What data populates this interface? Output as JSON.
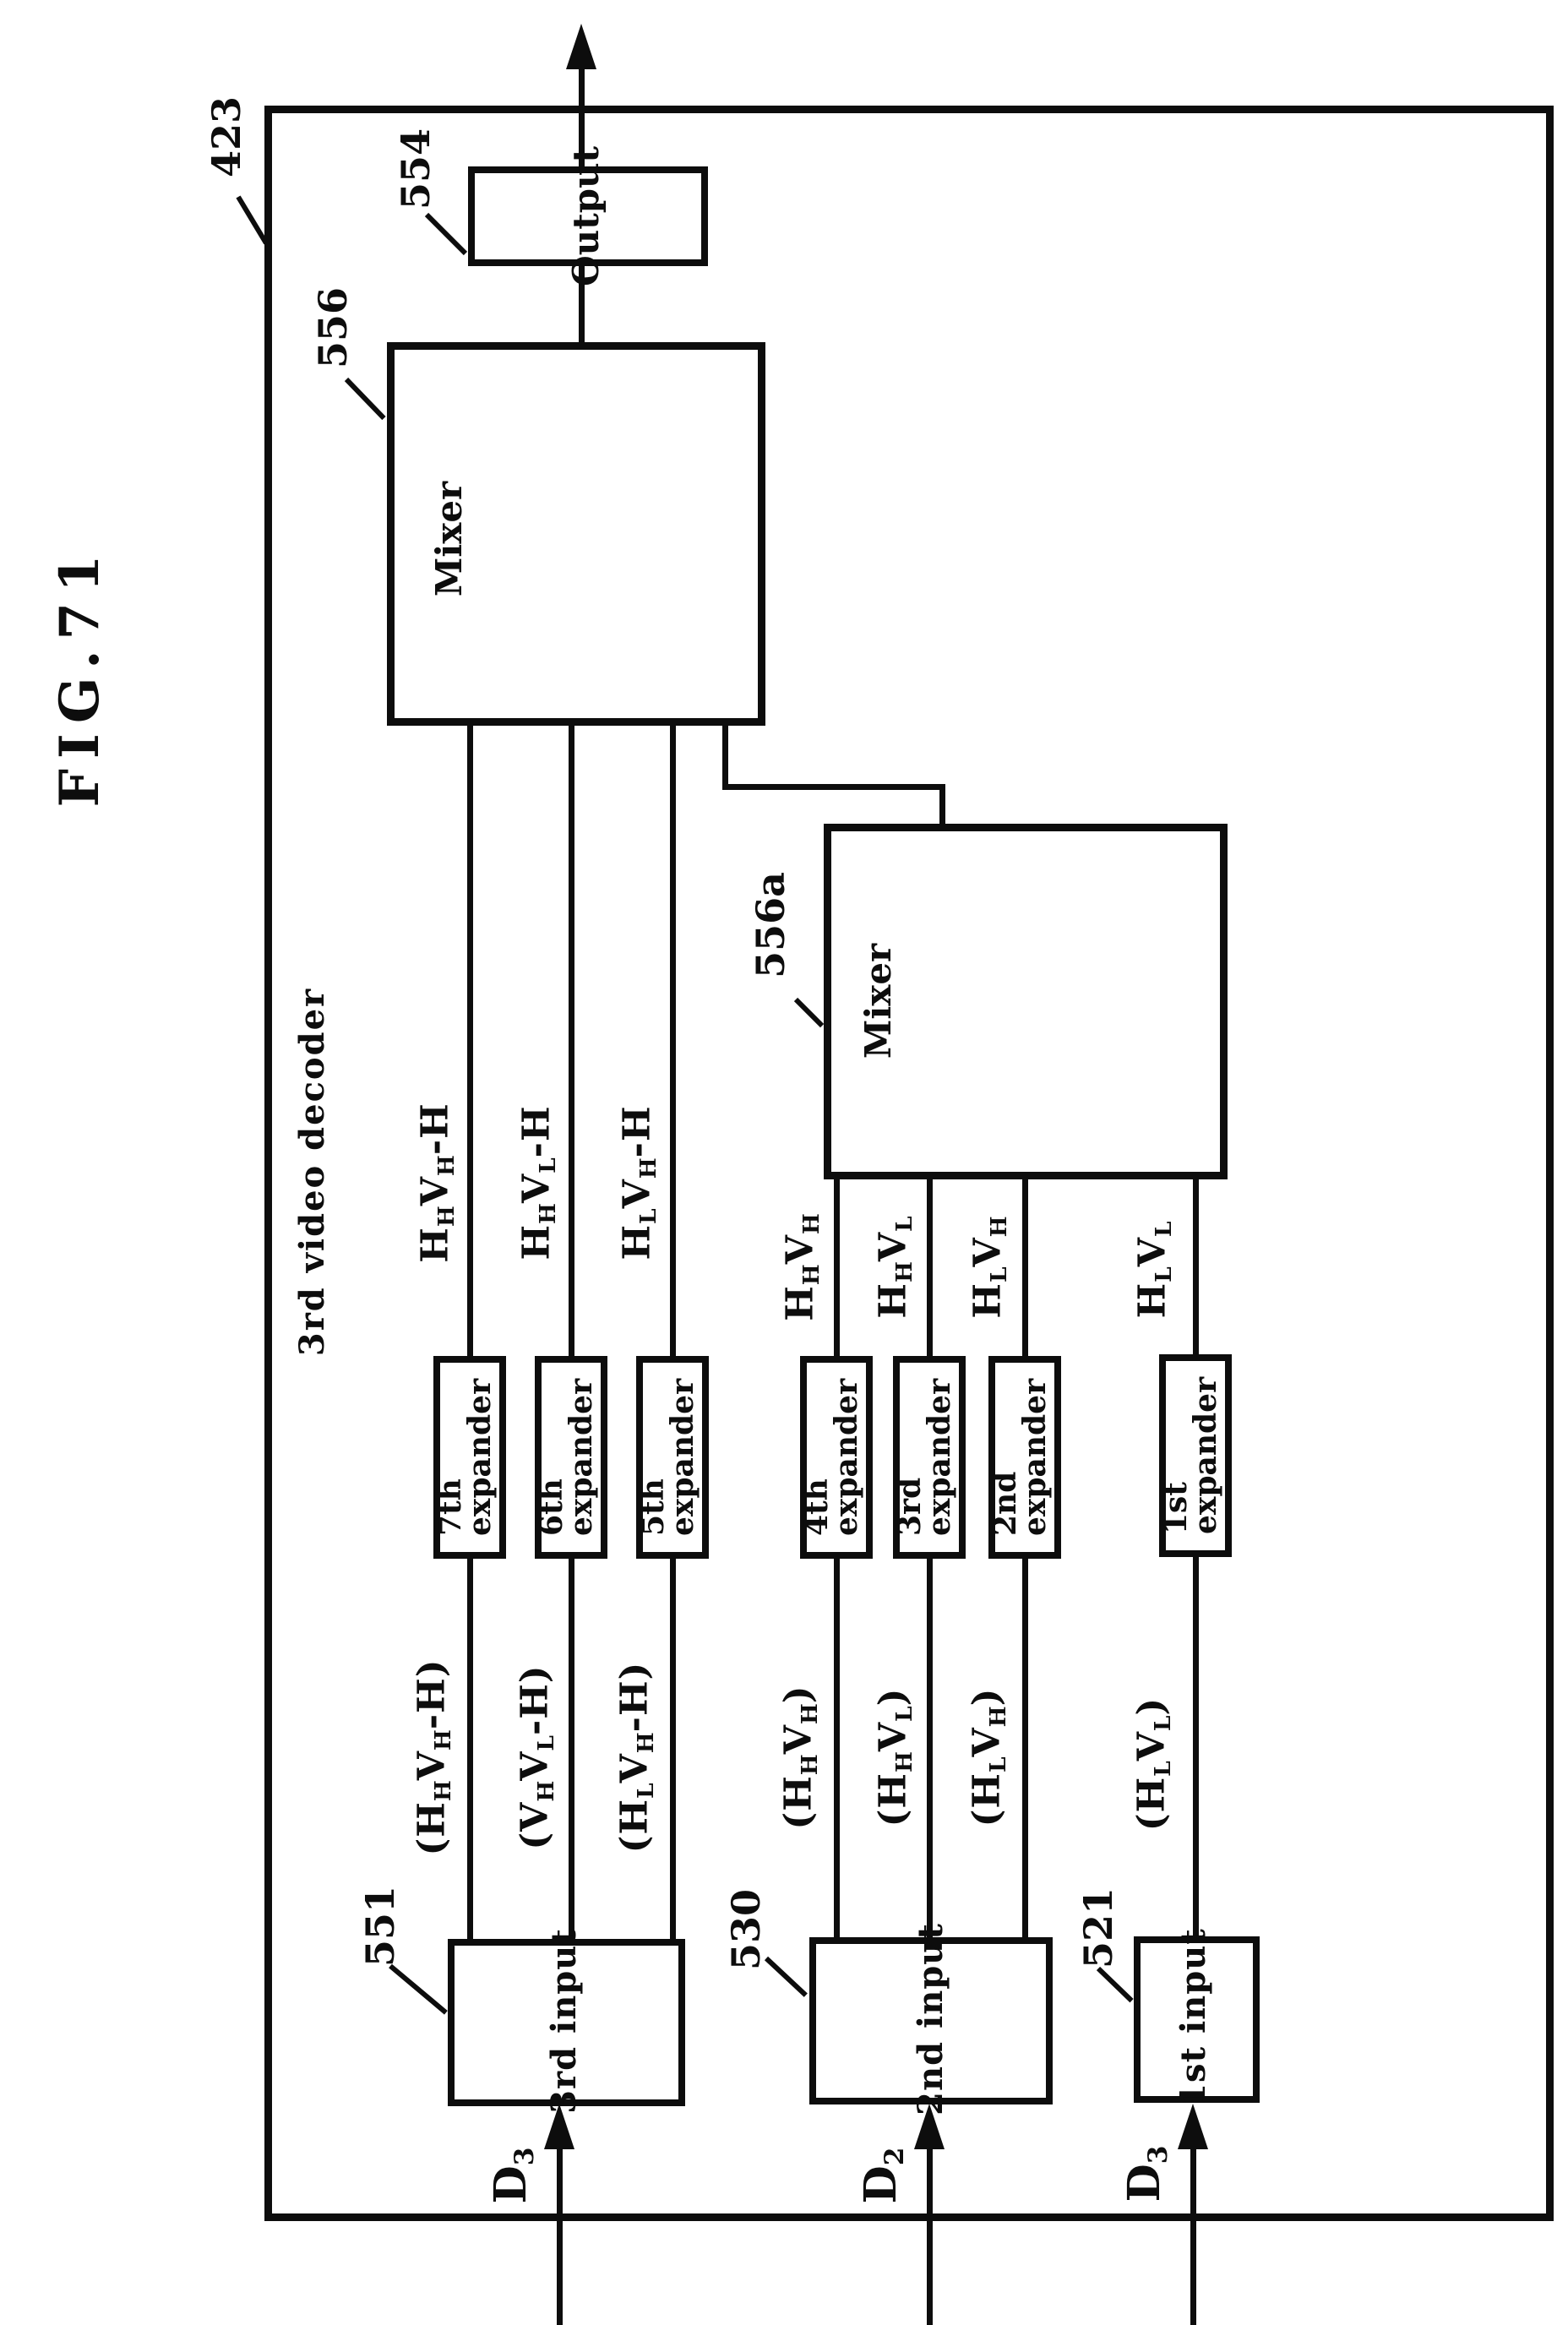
{
  "figure": {
    "title": "FIG.71",
    "system_label": "3rd video decoder",
    "outer_ref": "423"
  },
  "output_box": {
    "ref": "554",
    "label": "Output"
  },
  "mixers": [
    {
      "ref": "556",
      "label": "Mixer"
    },
    {
      "ref": "556a",
      "label": "Mixer"
    }
  ],
  "expanders": [
    {
      "line1": "7th",
      "line2": "expander"
    },
    {
      "line1": "6th",
      "line2": "expander"
    },
    {
      "line1": "5th",
      "line2": "expander"
    },
    {
      "line1": "4th",
      "line2": "expander"
    },
    {
      "line1": "3rd",
      "line2": "expander"
    },
    {
      "line1": "2nd",
      "line2": "expander"
    },
    {
      "line1": "1st",
      "line2": "expander"
    }
  ],
  "inputs": [
    {
      "ref": "551",
      "label": "3rd input"
    },
    {
      "ref": "530",
      "label": "2nd input"
    },
    {
      "ref": "521",
      "label": "1st input"
    }
  ],
  "signals": {
    "to_mixer_556": [
      {
        "parts": [
          {
            "t": "H",
            "sub": "H"
          },
          {
            "t": "V",
            "sub": "H"
          },
          {
            "t": "-H",
            "sub": ""
          }
        ]
      },
      {
        "parts": [
          {
            "t": "H",
            "sub": "H"
          },
          {
            "t": "V",
            "sub": "L"
          },
          {
            "t": "-H",
            "sub": ""
          }
        ]
      },
      {
        "parts": [
          {
            "t": "H",
            "sub": "L"
          },
          {
            "t": "V",
            "sub": "H"
          },
          {
            "t": "-H",
            "sub": ""
          }
        ]
      }
    ],
    "to_mixer_556a": [
      {
        "parts": [
          {
            "t": "H",
            "sub": "H"
          },
          {
            "t": "V",
            "sub": "H"
          }
        ]
      },
      {
        "parts": [
          {
            "t": "H",
            "sub": "H"
          },
          {
            "t": "V",
            "sub": "L"
          }
        ]
      },
      {
        "parts": [
          {
            "t": "H",
            "sub": "L"
          },
          {
            "t": "V",
            "sub": "H"
          }
        ]
      },
      {
        "parts": [
          {
            "t": "H",
            "sub": "L"
          },
          {
            "t": "V",
            "sub": "L"
          }
        ]
      }
    ],
    "from_inputs": [
      {
        "parts": [
          {
            "t": "(H",
            "sub": "H"
          },
          {
            "t": "V",
            "sub": "H"
          },
          {
            "t": "-H)",
            "sub": ""
          }
        ]
      },
      {
        "parts": [
          {
            "t": "(V",
            "sub": "H"
          },
          {
            "t": "V",
            "sub": "L"
          },
          {
            "t": "-H)",
            "sub": ""
          }
        ]
      },
      {
        "parts": [
          {
            "t": "(H",
            "sub": "L"
          },
          {
            "t": "V",
            "sub": "H"
          },
          {
            "t": "-H)",
            "sub": ""
          }
        ]
      },
      {
        "parts": [
          {
            "t": "(H",
            "sub": "H"
          },
          {
            "t": "V",
            "sub": "H"
          },
          {
            "t": ")",
            "sub": ""
          }
        ]
      },
      {
        "parts": [
          {
            "t": "(H",
            "sub": "H"
          },
          {
            "t": "V",
            "sub": "L"
          },
          {
            "t": ")",
            "sub": ""
          }
        ]
      },
      {
        "parts": [
          {
            "t": "(H",
            "sub": "L"
          },
          {
            "t": "V",
            "sub": "H"
          },
          {
            "t": ")",
            "sub": ""
          }
        ]
      },
      {
        "parts": [
          {
            "t": "(H",
            "sub": "L"
          },
          {
            "t": "V",
            "sub": "L"
          },
          {
            "t": ")",
            "sub": ""
          }
        ]
      }
    ],
    "external": [
      {
        "parts": [
          {
            "t": "D",
            "sub": "3"
          }
        ]
      },
      {
        "parts": [
          {
            "t": "D",
            "sub": "2"
          }
        ]
      },
      {
        "parts": [
          {
            "t": "D",
            "sub": "3"
          }
        ]
      }
    ]
  },
  "colors": {
    "ink": "#0d0d0d",
    "paper": "#ffffff"
  }
}
